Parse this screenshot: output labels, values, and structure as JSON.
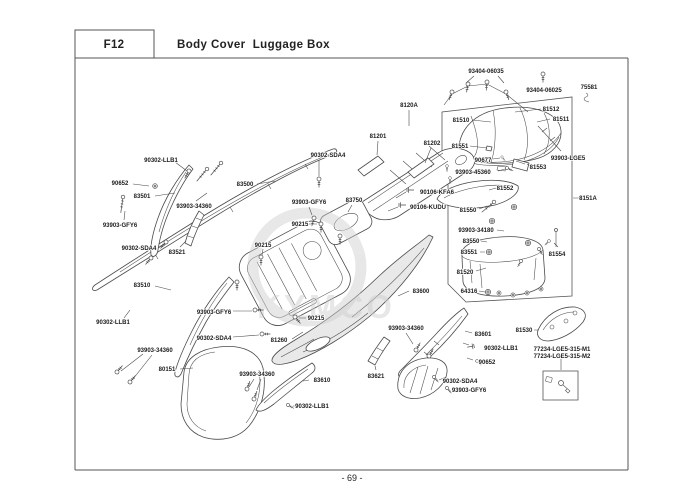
{
  "header": {
    "code": "F12",
    "title": "Body Cover  Luggage Box"
  },
  "footer": {
    "page_number": "- 69 -"
  },
  "watermark": {
    "text": "KYMCO"
  },
  "colors": {
    "line": "#4a4a4a",
    "label_text": "#1c1c1c",
    "border": "#555555",
    "watermark": "#cccccc",
    "background": "#ffffff"
  },
  "diagram": {
    "labels": [
      {
        "text": "93404-06035",
        "x": 486,
        "y": 71
      },
      {
        "text": "93404-06025",
        "x": 544,
        "y": 90
      },
      {
        "text": "75581",
        "x": 589,
        "y": 87
      },
      {
        "text": "81512",
        "x": 551,
        "y": 109
      },
      {
        "text": "81510",
        "x": 461,
        "y": 120
      },
      {
        "text": "81511",
        "x": 561,
        "y": 119
      },
      {
        "text": "81551",
        "x": 460,
        "y": 146
      },
      {
        "text": "90677",
        "x": 483,
        "y": 160
      },
      {
        "text": "93903-LGE5",
        "x": 568,
        "y": 158
      },
      {
        "text": "81553",
        "x": 538,
        "y": 167
      },
      {
        "text": "93903-45360",
        "x": 473,
        "y": 172
      },
      {
        "text": "81552",
        "x": 505,
        "y": 188
      },
      {
        "text": "8151A",
        "x": 588,
        "y": 198
      },
      {
        "text": "81550",
        "x": 468,
        "y": 210
      },
      {
        "text": "93903-34180",
        "x": 476,
        "y": 230
      },
      {
        "text": "83550",
        "x": 471,
        "y": 241
      },
      {
        "text": "83551",
        "x": 469,
        "y": 252
      },
      {
        "text": "81554",
        "x": 557,
        "y": 254
      },
      {
        "text": "81520",
        "x": 465,
        "y": 272
      },
      {
        "text": "64316",
        "x": 469,
        "y": 291
      },
      {
        "text": "8120A",
        "x": 409,
        "y": 105
      },
      {
        "text": "81201",
        "x": 378,
        "y": 136
      },
      {
        "text": "81202",
        "x": 432,
        "y": 143
      },
      {
        "text": "90106-KFA6",
        "x": 437,
        "y": 192
      },
      {
        "text": "90106-KUDU",
        "x": 428,
        "y": 207
      },
      {
        "text": "90302-SDA4",
        "x": 328,
        "y": 155
      },
      {
        "text": "83500",
        "x": 245,
        "y": 184
      },
      {
        "text": "93903-GFY6",
        "x": 309,
        "y": 202
      },
      {
        "text": "83750",
        "x": 354,
        "y": 200
      },
      {
        "text": "90215",
        "x": 300,
        "y": 224
      },
      {
        "text": "90215",
        "x": 263,
        "y": 245
      },
      {
        "text": "90215",
        "x": 316,
        "y": 318
      },
      {
        "text": "90302-LLB1",
        "x": 161,
        "y": 160
      },
      {
        "text": "90652",
        "x": 120,
        "y": 183
      },
      {
        "text": "83501",
        "x": 142,
        "y": 196
      },
      {
        "text": "93903-34360",
        "x": 194,
        "y": 206
      },
      {
        "text": "93903-GFY6",
        "x": 120,
        "y": 225
      },
      {
        "text": "90302-SDA4",
        "x": 139,
        "y": 248
      },
      {
        "text": "83521",
        "x": 177,
        "y": 252
      },
      {
        "text": "83510",
        "x": 142,
        "y": 285
      },
      {
        "text": "90302-LLB1",
        "x": 113,
        "y": 322
      },
      {
        "text": "93903-34360",
        "x": 155,
        "y": 350
      },
      {
        "text": "80151",
        "x": 167,
        "y": 369
      },
      {
        "text": "93903-GFY6",
        "x": 214,
        "y": 312
      },
      {
        "text": "90302-SDA4",
        "x": 214,
        "y": 338
      },
      {
        "text": "81260",
        "x": 279,
        "y": 340
      },
      {
        "text": "83600",
        "x": 421,
        "y": 291
      },
      {
        "text": "93903-34360",
        "x": 406,
        "y": 328
      },
      {
        "text": "83601",
        "x": 483,
        "y": 334
      },
      {
        "text": "90302-LLB1",
        "x": 501,
        "y": 348
      },
      {
        "text": "90652",
        "x": 487,
        "y": 362
      },
      {
        "text": "77234-LGE5-315-M1",
        "x": 562,
        "y": 349
      },
      {
        "text": "77234-LGE5-315-M2",
        "x": 562,
        "y": 356
      },
      {
        "text": "81530",
        "x": 524,
        "y": 330
      },
      {
        "text": "83621",
        "x": 376,
        "y": 376
      },
      {
        "text": "83610",
        "x": 322,
        "y": 380
      },
      {
        "text": "93903-34360",
        "x": 257,
        "y": 374
      },
      {
        "text": "90302-LLB1",
        "x": 312,
        "y": 406
      },
      {
        "text": "90302-SDA4",
        "x": 460,
        "y": 381
      },
      {
        "text": "93903-GFY6",
        "x": 469,
        "y": 390
      }
    ]
  }
}
